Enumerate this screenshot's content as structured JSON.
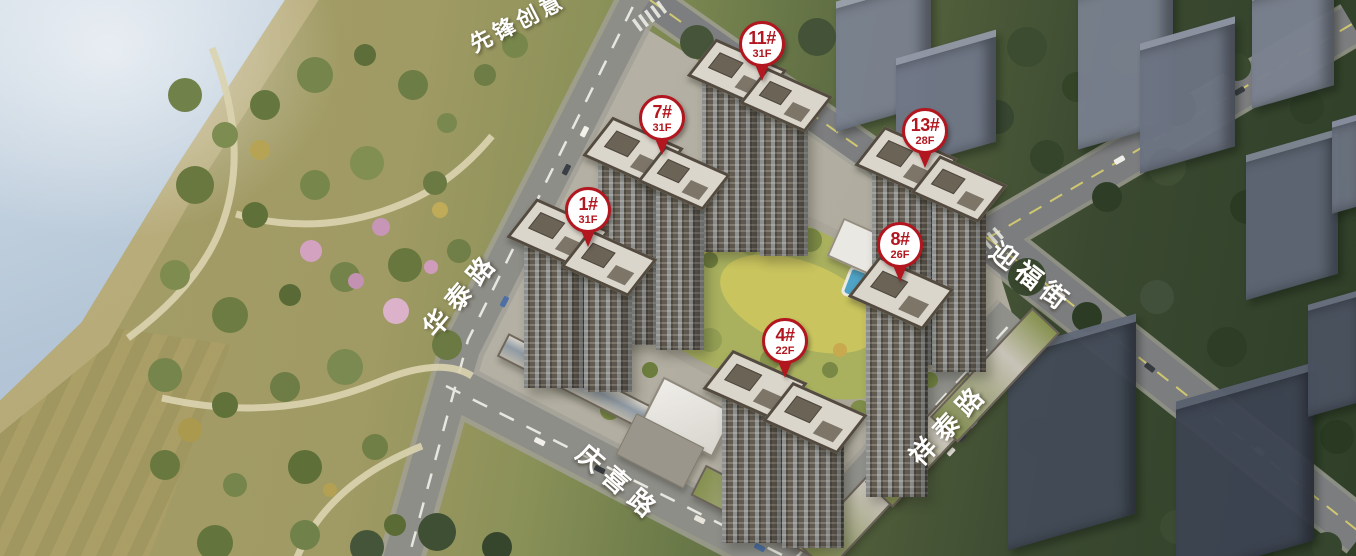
{
  "pins": [
    {
      "id": "1#",
      "floors": "31F",
      "x": 588,
      "y": 210
    },
    {
      "id": "4#",
      "floors": "22F",
      "x": 785,
      "y": 341
    },
    {
      "id": "7#",
      "floors": "31F",
      "x": 662,
      "y": 118
    },
    {
      "id": "8#",
      "floors": "26F",
      "x": 900,
      "y": 245
    },
    {
      "id": "11#",
      "floors": "31F",
      "x": 762,
      "y": 44
    },
    {
      "id": "13#",
      "floors": "28F",
      "x": 925,
      "y": 131
    }
  ],
  "road_labels": [
    {
      "text": "华泰路",
      "x": 460,
      "y": 293,
      "rotation": -50,
      "font_size": 26,
      "letter_spacing": 8
    },
    {
      "text": "庆喜路",
      "x": 620,
      "y": 482,
      "rotation": 41,
      "font_size": 26,
      "letter_spacing": 8
    },
    {
      "text": "祥泰路",
      "x": 948,
      "y": 423,
      "rotation": -47,
      "font_size": 26,
      "letter_spacing": 8
    },
    {
      "text": "迎福街",
      "x": 1032,
      "y": 276,
      "rotation": 38,
      "font_size": 26,
      "letter_spacing": 6
    },
    {
      "text": "先锋创意",
      "x": 517,
      "y": 21,
      "rotation": -27,
      "font_size": 22,
      "letter_spacing": 4
    }
  ],
  "colors": {
    "pin_red": "#b2161e",
    "pin_fill": "#ffffff",
    "road_label_color": "#ffffff"
  }
}
